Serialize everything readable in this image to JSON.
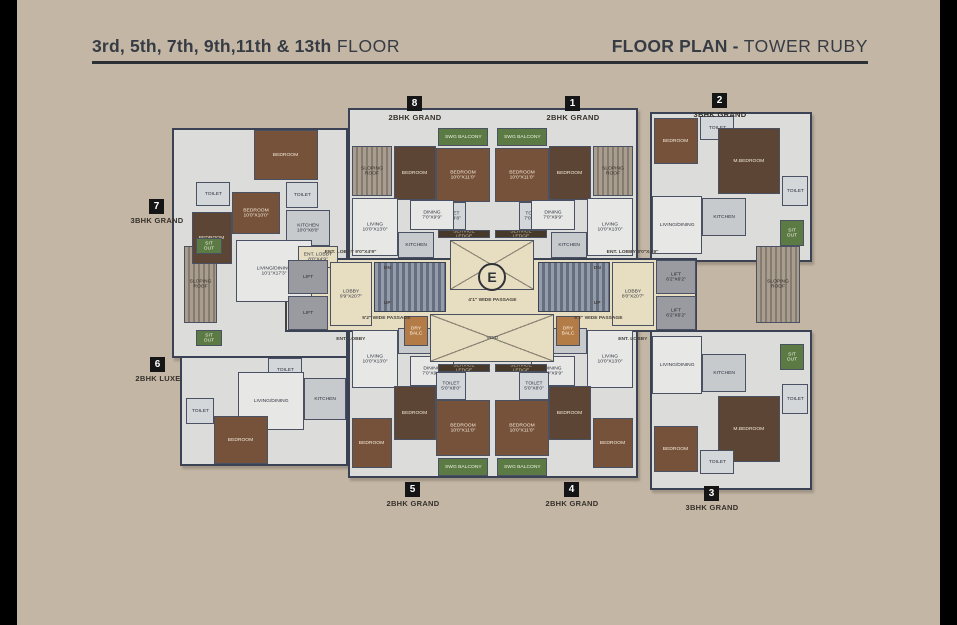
{
  "header": {
    "floors_bold": "3rd, 5th, 7th, 9th,11th & 13th",
    "floors_regular": " FLOOR",
    "plan_bold": "FLOOR PLAN - ",
    "plan_regular": " TOWER RUBY"
  },
  "colors": {
    "background": "#c3b6a5",
    "side_bars": "#000000",
    "header_text": "#363b44",
    "walls": "#3a4254",
    "lobby_cream": "#e7ddc1",
    "bedroom_wood": "#77523a",
    "balcony_green": "#5c7a44"
  },
  "units": [
    {
      "num": "8",
      "type": "2BHK GRAND",
      "x": 415,
      "y": 96
    },
    {
      "num": "1",
      "type": "2BHK GRAND",
      "x": 573,
      "y": 96
    },
    {
      "num": "2",
      "type": "3BHK GRAND",
      "x": 720,
      "y": 93
    },
    {
      "num": "7",
      "type": "3BHK GRAND",
      "x": 157,
      "y": 199
    },
    {
      "num": "6",
      "type": "2BHK LUXE",
      "x": 158,
      "y": 357
    },
    {
      "num": "5",
      "type": "2BHK GRAND",
      "x": 413,
      "y": 482
    },
    {
      "num": "4",
      "type": "2BHK GRAND",
      "x": 572,
      "y": 482
    },
    {
      "num": "3",
      "type": "3BHK GRAND",
      "x": 712,
      "y": 486
    }
  ],
  "plan": {
    "rooms": [
      {
        "n": "unit7-wing",
        "t": "",
        "c": "wing",
        "x": 172,
        "y": 128,
        "w": 176,
        "h": 230
      },
      {
        "n": "unit6-wing",
        "t": "",
        "c": "wing",
        "x": 180,
        "y": 356,
        "w": 168,
        "h": 110
      },
      {
        "n": "top-center-wing",
        "t": "",
        "c": "wing",
        "x": 348,
        "y": 108,
        "w": 290,
        "h": 152
      },
      {
        "n": "unit2-wing",
        "t": "",
        "c": "wing",
        "x": 650,
        "y": 112,
        "w": 162,
        "h": 150
      },
      {
        "n": "bottom-center-wing",
        "t": "",
        "c": "wing",
        "x": 348,
        "y": 312,
        "w": 290,
        "h": 166
      },
      {
        "n": "unit3-wing",
        "t": "",
        "c": "wing",
        "x": 650,
        "y": 330,
        "w": 162,
        "h": 160
      },
      {
        "n": "core-band",
        "t": "",
        "c": "band",
        "x": 285,
        "y": 258,
        "w": 412,
        "h": 74
      },
      {
        "n": "sloping-roof-left",
        "t": "SLOPING ROOF",
        "c": "roof",
        "x": 184,
        "y": 246,
        "w": 33,
        "h": 77
      },
      {
        "n": "sloping-roof-right",
        "t": "SLOPING ROOF",
        "c": "roof",
        "x": 756,
        "y": 246,
        "w": 44,
        "h": 77
      },
      {
        "n": "u7-bedroom-1",
        "t": "BEDROOM",
        "c": "wood",
        "x": 254,
        "y": 130,
        "w": 64,
        "h": 50
      },
      {
        "n": "u7-toilet-1",
        "t": "TOILET",
        "c": "toilet",
        "x": 196,
        "y": 182,
        "w": 34,
        "h": 24
      },
      {
        "n": "u7-bedroom-2",
        "t": "BEDROOM 10'0\"X10'0\"",
        "c": "wood",
        "x": 232,
        "y": 192,
        "w": 48,
        "h": 42
      },
      {
        "n": "u7-bedroom-3",
        "t": "BEDROOM",
        "c": "wood2",
        "x": 192,
        "y": 212,
        "w": 40,
        "h": 52
      },
      {
        "n": "u7-toilet-2",
        "t": "TOILET",
        "c": "toilet",
        "x": 286,
        "y": 182,
        "w": 32,
        "h": 26
      },
      {
        "n": "u7-kitchen",
        "t": "KITCHEN 10'0\"X8'0\"",
        "c": "kitchen",
        "x": 286,
        "y": 210,
        "w": 44,
        "h": 36
      },
      {
        "n": "u7-living",
        "t": "LIVING/DINING 10'1\"X17'3\"",
        "c": "living",
        "x": 236,
        "y": 240,
        "w": 76,
        "h": 62
      },
      {
        "n": "u7-ent-lobby",
        "t": "ENT. LOBBY 8'0\"X4'9\"",
        "c": "cream",
        "x": 298,
        "y": 246,
        "w": 40,
        "h": 22
      },
      {
        "n": "u7-sitout-1",
        "t": "SIT OUT",
        "c": "green",
        "x": 196,
        "y": 238,
        "w": 26,
        "h": 16
      },
      {
        "n": "u7-sitout-2",
        "t": "SIT OUT",
        "c": "green",
        "x": 196,
        "y": 330,
        "w": 26,
        "h": 16
      },
      {
        "n": "u6-toilet-1",
        "t": "TOILET",
        "c": "toilet",
        "x": 268,
        "y": 358,
        "w": 34,
        "h": 24
      },
      {
        "n": "u6-living",
        "t": "LIVING/DINING",
        "c": "living",
        "x": 238,
        "y": 372,
        "w": 66,
        "h": 58
      },
      {
        "n": "u6-kitchen",
        "t": "KITCHEN",
        "c": "kitchen",
        "x": 304,
        "y": 378,
        "w": 42,
        "h": 42
      },
      {
        "n": "u6-bedroom",
        "t": "BEDROOM",
        "c": "wood",
        "x": 214,
        "y": 416,
        "w": 54,
        "h": 48
      },
      {
        "n": "u6-toilet-2",
        "t": "TOILET",
        "c": "toilet",
        "x": 186,
        "y": 398,
        "w": 28,
        "h": 26
      },
      {
        "n": "u8-sloping-roof",
        "t": "SLOPING ROOF",
        "c": "roof",
        "x": 352,
        "y": 146,
        "w": 40,
        "h": 50
      },
      {
        "n": "u8-bedroom-2",
        "t": "BEDROOM",
        "c": "wood2",
        "x": 394,
        "y": 146,
        "w": 42,
        "h": 54
      },
      {
        "n": "u8-swg-balcony",
        "t": "SWG BALCONY",
        "c": "green",
        "x": 438,
        "y": 128,
        "w": 50,
        "h": 18
      },
      {
        "n": "u8-bedroom-1",
        "t": "BEDROOM 10'0\"X11'0\"",
        "c": "wood",
        "x": 436,
        "y": 148,
        "w": 54,
        "h": 54
      },
      {
        "n": "u8-toilet",
        "t": "TOILET 7'0\"X4'8\"",
        "c": "toilet",
        "x": 436,
        "y": 202,
        "w": 30,
        "h": 28
      },
      {
        "n": "u8-living",
        "t": "LIVING 10'0\"X13'0\"",
        "c": "living",
        "x": 352,
        "y": 198,
        "w": 46,
        "h": 58
      },
      {
        "n": "u8-dining",
        "t": "DINING 7'0\"X9'9\"",
        "c": "living",
        "x": 410,
        "y": 200,
        "w": 44,
        "h": 30
      },
      {
        "n": "u8-kitchen",
        "t": "KITCHEN",
        "c": "kitchen",
        "x": 398,
        "y": 232,
        "w": 36,
        "h": 26
      },
      {
        "n": "u1-sloping-roof",
        "t": "SLOPING ROOF",
        "c": "roof",
        "x": 593,
        "y": 146,
        "w": 40,
        "h": 50
      },
      {
        "n": "u1-bedroom-2",
        "t": "BEDROOM",
        "c": "wood2",
        "x": 549,
        "y": 146,
        "w": 42,
        "h": 54
      },
      {
        "n": "u1-swg-balcony",
        "t": "SWG BALCONY",
        "c": "green",
        "x": 497,
        "y": 128,
        "w": 50,
        "h": 18
      },
      {
        "n": "u1-bedroom-1",
        "t": "BEDROOM 10'0\"X11'0\"",
        "c": "wood",
        "x": 495,
        "y": 148,
        "w": 54,
        "h": 54
      },
      {
        "n": "u1-toilet",
        "t": "TOILET 7'0\"X4'8\"",
        "c": "toilet",
        "x": 519,
        "y": 202,
        "w": 30,
        "h": 28
      },
      {
        "n": "u1-living",
        "t": "LIVING 10'0\"X13'0\"",
        "c": "living",
        "x": 587,
        "y": 198,
        "w": 46,
        "h": 58
      },
      {
        "n": "u1-dining",
        "t": "DINING 7'0\"X9'9\"",
        "c": "living",
        "x": 531,
        "y": 200,
        "w": 44,
        "h": 30
      },
      {
        "n": "u1-kitchen",
        "t": "KITCHEN",
        "c": "kitchen",
        "x": 551,
        "y": 232,
        "w": 36,
        "h": 26
      },
      {
        "n": "u2-bedroom-1",
        "t": "BEDROOM",
        "c": "wood",
        "x": 654,
        "y": 118,
        "w": 44,
        "h": 46
      },
      {
        "n": "u2-toilet-1",
        "t": "TOILET",
        "c": "toilet",
        "x": 700,
        "y": 116,
        "w": 34,
        "h": 24
      },
      {
        "n": "u2-mbedroom",
        "t": "M.BEDROOM",
        "c": "wood2",
        "x": 718,
        "y": 128,
        "w": 62,
        "h": 66
      },
      {
        "n": "u2-toilet-2",
        "t": "TOILET",
        "c": "toilet",
        "x": 782,
        "y": 176,
        "w": 26,
        "h": 30
      },
      {
        "n": "u2-living",
        "t": "LIVING/DINING",
        "c": "living",
        "x": 652,
        "y": 196,
        "w": 50,
        "h": 58
      },
      {
        "n": "u2-kitchen",
        "t": "KITCHEN",
        "c": "kitchen",
        "x": 702,
        "y": 198,
        "w": 44,
        "h": 38
      },
      {
        "n": "u2-sitout",
        "t": "SIT OUT",
        "c": "green",
        "x": 780,
        "y": 220,
        "w": 24,
        "h": 26
      },
      {
        "n": "u3-living",
        "t": "LIVING/DINING",
        "c": "living",
        "x": 652,
        "y": 336,
        "w": 50,
        "h": 58
      },
      {
        "n": "u3-kitchen",
        "t": "KITCHEN",
        "c": "kitchen",
        "x": 702,
        "y": 354,
        "w": 44,
        "h": 38
      },
      {
        "n": "u3-sitout",
        "t": "SIT OUT",
        "c": "green",
        "x": 780,
        "y": 344,
        "w": 24,
        "h": 26
      },
      {
        "n": "u3-mbedroom",
        "t": "M.BEDROOM",
        "c": "wood2",
        "x": 718,
        "y": 396,
        "w": 62,
        "h": 66
      },
      {
        "n": "u3-bedroom-1",
        "t": "BEDROOM",
        "c": "wood",
        "x": 654,
        "y": 426,
        "w": 44,
        "h": 46
      },
      {
        "n": "u3-toilet-2",
        "t": "TOILET",
        "c": "toilet",
        "x": 782,
        "y": 384,
        "w": 26,
        "h": 30
      },
      {
        "n": "u3-toilet-1",
        "t": "TOILET",
        "c": "toilet",
        "x": 700,
        "y": 450,
        "w": 34,
        "h": 24
      },
      {
        "n": "u5-living",
        "t": "LIVING 10'0\"X13'0\"",
        "c": "living",
        "x": 352,
        "y": 330,
        "w": 46,
        "h": 58
      },
      {
        "n": "u5-kitchen",
        "t": "KITCHEN",
        "c": "kitchen",
        "x": 398,
        "y": 328,
        "w": 36,
        "h": 26
      },
      {
        "n": "u5-dining",
        "t": "DINING 7'0\"X9'9\"",
        "c": "living",
        "x": 410,
        "y": 356,
        "w": 44,
        "h": 30
      },
      {
        "n": "u5-bedroom-2",
        "t": "BEDROOM",
        "c": "wood2",
        "x": 394,
        "y": 386,
        "w": 42,
        "h": 54
      },
      {
        "n": "u5-bedroom-3",
        "t": "BEDROOM",
        "c": "wood",
        "x": 352,
        "y": 418,
        "w": 40,
        "h": 50
      },
      {
        "n": "u5-toilet",
        "t": "TOILET 5'0\"X8'0\"",
        "c": "toilet",
        "x": 436,
        "y": 372,
        "w": 30,
        "h": 28
      },
      {
        "n": "u5-bedroom-1",
        "t": "BEDROOM 10'0\"X11'0\"",
        "c": "wood",
        "x": 436,
        "y": 400,
        "w": 54,
        "h": 56
      },
      {
        "n": "u5-swg-balcony",
        "t": "SWG BALCONY",
        "c": "green",
        "x": 438,
        "y": 458,
        "w": 50,
        "h": 18
      },
      {
        "n": "u4-living",
        "t": "LIVING 10'0\"X13'0\"",
        "c": "living",
        "x": 587,
        "y": 330,
        "w": 46,
        "h": 58
      },
      {
        "n": "u4-kitchen",
        "t": "KITCHEN",
        "c": "kitchen",
        "x": 551,
        "y": 328,
        "w": 36,
        "h": 26
      },
      {
        "n": "u4-dining",
        "t": "DINING 7'0\"X9'9\"",
        "c": "living",
        "x": 531,
        "y": 356,
        "w": 44,
        "h": 30
      },
      {
        "n": "u4-bedroom-2",
        "t": "BEDROOM",
        "c": "wood2",
        "x": 549,
        "y": 386,
        "w": 42,
        "h": 54
      },
      {
        "n": "u4-bedroom-3",
        "t": "BEDROOM",
        "c": "wood",
        "x": 593,
        "y": 418,
        "w": 40,
        "h": 50
      },
      {
        "n": "u4-toilet",
        "t": "TOILET 5'0\"X8'0\"",
        "c": "toilet",
        "x": 519,
        "y": 372,
        "w": 30,
        "h": 28
      },
      {
        "n": "u4-bedroom-1",
        "t": "BEDROOM 10'0\"X11'0\"",
        "c": "wood",
        "x": 495,
        "y": 400,
        "w": 54,
        "h": 56
      },
      {
        "n": "u4-swg-balcony",
        "t": "SWG BALCONY",
        "c": "green",
        "x": 497,
        "y": 458,
        "w": 50,
        "h": 18
      },
      {
        "n": "service-ledge-top-left",
        "t": "SERVICE LEDGE",
        "c": "ledge",
        "x": 438,
        "y": 230,
        "w": 52,
        "h": 8
      },
      {
        "n": "service-ledge-top-right",
        "t": "SERVICE LEDGE",
        "c": "ledge",
        "x": 495,
        "y": 230,
        "w": 52,
        "h": 8
      },
      {
        "n": "ots-xbrace",
        "t": "",
        "c": "xbrace",
        "x": 450,
        "y": 240,
        "w": 84,
        "h": 50
      },
      {
        "n": "void-xbrace",
        "t": "VOID",
        "c": "xbrace",
        "x": 430,
        "y": 314,
        "w": 124,
        "h": 48
      },
      {
        "n": "service-ledge-bottom-left",
        "t": "SERVICE LEDGE",
        "c": "ledge",
        "x": 438,
        "y": 364,
        "w": 52,
        "h": 8
      },
      {
        "n": "service-ledge-bottom-right",
        "t": "SERVICE LEDGE",
        "c": "ledge",
        "x": 495,
        "y": 364,
        "w": 52,
        "h": 8
      },
      {
        "n": "dry-balcony-left",
        "t": "DRY BALC",
        "c": "balc",
        "x": 404,
        "y": 316,
        "w": 24,
        "h": 30
      },
      {
        "n": "dry-balcony-right",
        "t": "DRY BALC",
        "c": "balc",
        "x": 556,
        "y": 316,
        "w": 24,
        "h": 30
      },
      {
        "n": "lift-left-1",
        "t": "LIFT",
        "c": "lift",
        "x": 288,
        "y": 260,
        "w": 40,
        "h": 34
      },
      {
        "n": "lift-left-2",
        "t": "LIFT",
        "c": "lift",
        "x": 288,
        "y": 296,
        "w": 40,
        "h": 34
      },
      {
        "n": "lobby-left",
        "t": "LOBBY 9'9\"X20'7\"",
        "c": "cream",
        "x": 330,
        "y": 262,
        "w": 42,
        "h": 64
      },
      {
        "n": "stairs-left",
        "t": "",
        "c": "stair",
        "x": 374,
        "y": 262,
        "w": 72,
        "h": 50
      },
      {
        "n": "stairs-right",
        "t": "",
        "c": "stair",
        "x": 538,
        "y": 262,
        "w": 72,
        "h": 50
      },
      {
        "n": "lobby-right",
        "t": "LOBBY 8'0\"X20'7\"",
        "c": "cream",
        "x": 612,
        "y": 262,
        "w": 42,
        "h": 64
      },
      {
        "n": "lift-right-1",
        "t": "LIFT 6'2\"X6'2\"",
        "c": "lift",
        "x": 656,
        "y": 260,
        "w": 40,
        "h": 34
      },
      {
        "n": "lift-right-2",
        "t": "LIFT 6'2\"X6'2\"",
        "c": "lift",
        "x": 656,
        "y": 296,
        "w": 40,
        "h": 34
      },
      {
        "n": "elevator-symbol",
        "t": "E",
        "c": "ecircle",
        "x": 478,
        "y": 263,
        "w": 28,
        "h": 28
      },
      {
        "n": "stairs-left-dn-label",
        "t": "DN",
        "c": "lbl",
        "x": 378,
        "y": 264,
        "w": 18,
        "h": 9
      },
      {
        "n": "stairs-left-up-label",
        "t": "UP",
        "c": "lbl",
        "x": 378,
        "y": 299,
        "w": 18,
        "h": 9
      },
      {
        "n": "stairs-right-dn-label",
        "t": "DN",
        "c": "lbl",
        "x": 588,
        "y": 264,
        "w": 18,
        "h": 9
      },
      {
        "n": "stairs-right-up-label",
        "t": "UP",
        "c": "lbl",
        "x": 588,
        "y": 299,
        "w": 18,
        "h": 9
      },
      {
        "n": "ent-lobby-top-left-label",
        "t": "ENT. LOBBY 9'0\"X4'9\"",
        "c": "lbl",
        "x": 322,
        "y": 247,
        "w": 58,
        "h": 11
      },
      {
        "n": "ent-lobby-top-right-label",
        "t": "ENT. LOBBY 8'0\"X4'9\"",
        "c": "lbl",
        "x": 604,
        "y": 247,
        "w": 58,
        "h": 11
      },
      {
        "n": "ent-lobby-bottom-left-label",
        "t": "ENT. LOBBY",
        "c": "lbl",
        "x": 328,
        "y": 334,
        "w": 46,
        "h": 11
      },
      {
        "n": "ent-lobby-bottom-right-label",
        "t": "ENT. LOBBY",
        "c": "lbl",
        "x": 610,
        "y": 334,
        "w": 46,
        "h": 11
      },
      {
        "n": "passage-41-label",
        "t": "4'1\" WIDE PASSAGE",
        "c": "lbl",
        "x": 447,
        "y": 295,
        "w": 90,
        "h": 11
      },
      {
        "n": "passage-52-left-label",
        "t": "5'2\" WIDE PASSAGE",
        "c": "lbl",
        "x": 346,
        "y": 313,
        "w": 80,
        "h": 11
      },
      {
        "n": "passage-52-right-label",
        "t": "5'2\" WIDE PASSAGE",
        "c": "lbl",
        "x": 558,
        "y": 313,
        "w": 80,
        "h": 11
      }
    ]
  }
}
